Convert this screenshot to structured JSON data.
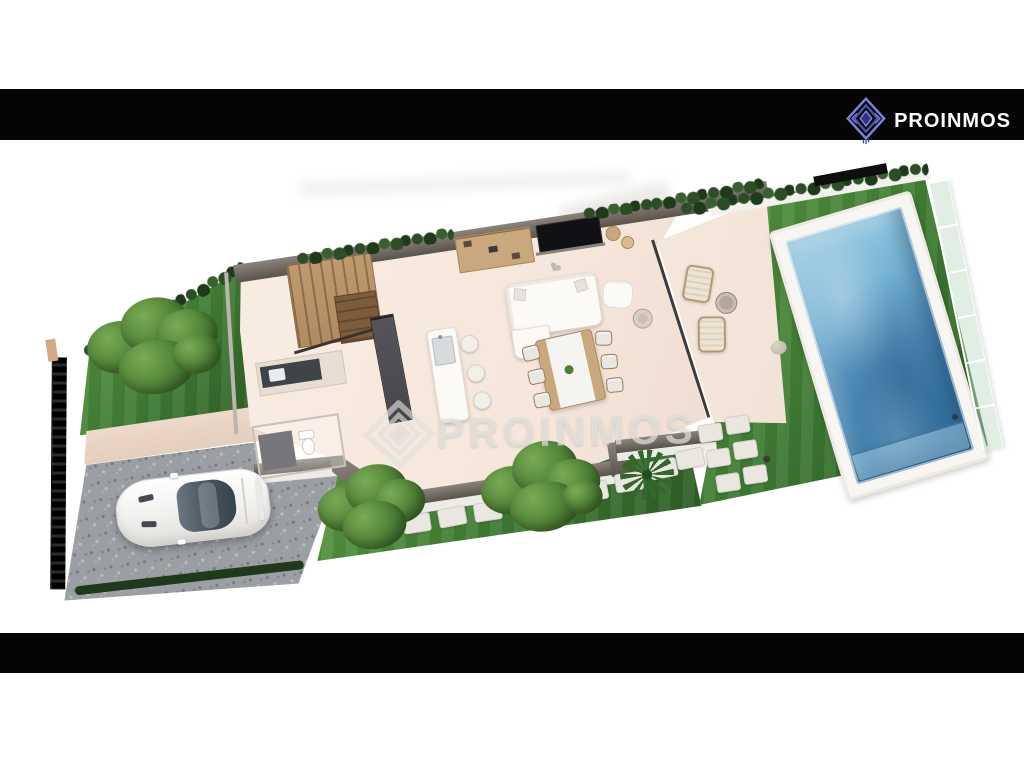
{
  "brand": {
    "name": "PROINMOS"
  },
  "header_bar": {
    "background": "#050505",
    "logo_icon": "nested-diamond-icon",
    "text_color": "#ffffff"
  },
  "footer_bar": {
    "background": "#050505"
  },
  "watermark": {
    "text": "PROINMOS",
    "icon": "nested-diamond-icon",
    "color": "#e2e0dd"
  },
  "scene": {
    "type": "3d-floorplan-render",
    "view": "aerial-tilted",
    "objects": [
      "boundary-fence",
      "left-garden-lawn",
      "garden-tree",
      "perimeter-hedge",
      "concrete-path",
      "gravel-driveway",
      "white-sports-car",
      "staircase",
      "bathroom-toilet",
      "kitchen-counter",
      "tall-kitchen-cabinets",
      "kitchen-island-with-sink",
      "bar-stools",
      "tv-media-wall",
      "shelf-unit",
      "corner-sofa",
      "armchair",
      "side-table",
      "heart-pillow",
      "dining-table",
      "dining-chairs",
      "glass-partition",
      "terrace",
      "lounge-chairs",
      "terrace-table",
      "rear-lawn",
      "stepping-stones",
      "palm-plant",
      "garden-bush",
      "swimming-pool",
      "pool-deck",
      "glass-pool-fence"
    ],
    "colors": {
      "bar": "#050505",
      "brand": "#5b5ec9",
      "brandDark": "#2e3190",
      "grass": "#3f7c33",
      "grassLight": "#5d9a44",
      "grassDark": "#2d5c25",
      "hedge": "#2c4d26",
      "hedgeDark": "#1f3a1b",
      "path": "#eedacb",
      "floor": "#f6e7dc",
      "terrace": "#f1e2d6",
      "wallTop": "#8a847c",
      "wallTopDark": "#59534c",
      "wallFace": "#edebe7",
      "gravel": "#9b9ea2",
      "gravelDark": "#75797e",
      "gravelLight": "#b9bcc0",
      "fence": "#161616",
      "wood": "#b18a62",
      "woodDark": "#7c5c3c",
      "cabinet": "#47464c",
      "furn": "#fbfaf7",
      "furnEdge": "#e3ded7",
      "tan": "#c9a87e",
      "tanDark": "#9d7b52",
      "pool1": "#a3d2e6",
      "pool2": "#4f8db9",
      "pool3": "#2e6b9b",
      "deck": "#f8f6f2",
      "glassFence": "#bcd9c4"
    }
  }
}
